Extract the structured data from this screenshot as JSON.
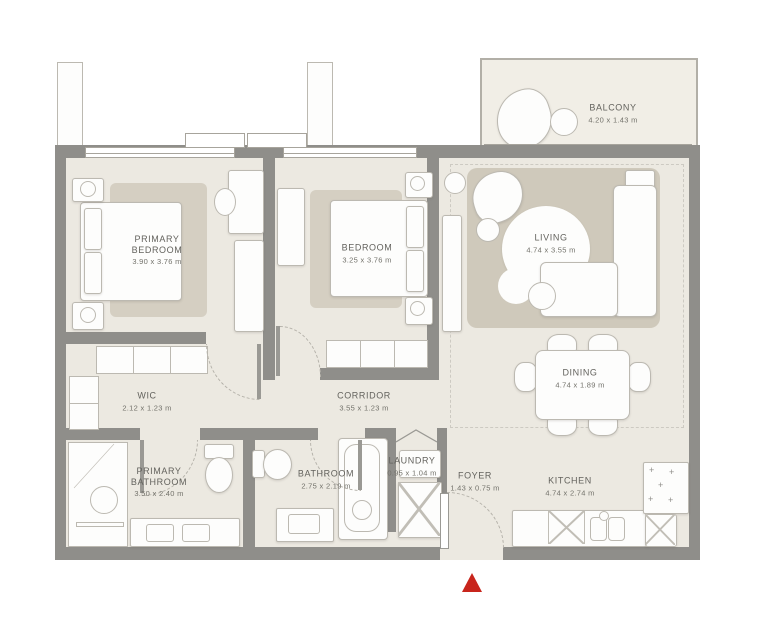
{
  "plan": {
    "rooms": [
      {
        "id": "primary-bedroom",
        "name": "PRIMARY BEDROOM",
        "dims": "3.90 x 3.76 m"
      },
      {
        "id": "bedroom",
        "name": "BEDROOM",
        "dims": "3.25 x 3.76 m"
      },
      {
        "id": "living",
        "name": "LIVING",
        "dims": "4.74 x 3.55 m"
      },
      {
        "id": "dining",
        "name": "DINING",
        "dims": "4.74 x 1.89 m"
      },
      {
        "id": "wic",
        "name": "WIC",
        "dims": "2.12 x 1.23 m"
      },
      {
        "id": "corridor",
        "name": "CORRIDOR",
        "dims": "3.55 x 1.23 m"
      },
      {
        "id": "primary-bathroom",
        "name": "PRIMARY BATHROOM",
        "dims": "3.50 x 2.40 m"
      },
      {
        "id": "bathroom",
        "name": "BATHROOM",
        "dims": "2.75 x 2.19 m"
      },
      {
        "id": "laundry",
        "name": "LAUNDRY",
        "dims": "0.95 x 1.04 m"
      },
      {
        "id": "foyer",
        "name": "FOYER",
        "dims": "1.43 x 0.75 m"
      },
      {
        "id": "kitchen",
        "name": "KITCHEN",
        "dims": "4.74 x 2.74 m"
      },
      {
        "id": "balcony",
        "name": "BALCONY",
        "dims": "4.20 x 1.43 m"
      }
    ],
    "colors": {
      "walls": "#8f8e8a",
      "floor": "#ece9e1",
      "rug": "#d5cfc2",
      "entry_marker": "#c8251c"
    },
    "icons": {
      "entry_marker": "red-triangle-up"
    }
  }
}
